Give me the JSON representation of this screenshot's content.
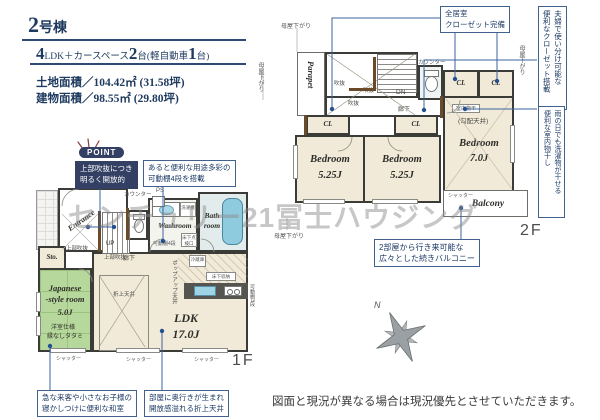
{
  "header": {
    "building_number": "2",
    "building_suffix": "号棟",
    "spec": {
      "n1": "4",
      "t1": "LDK＋カースペース",
      "n2": "2",
      "t2": "台(軽自動車",
      "n3": "1",
      "t3": "台)"
    },
    "land_area": "土地面積／104.42㎡ (31.58坪)",
    "building_area": "建物面積／98.55㎡ (29.80坪)"
  },
  "callouts": {
    "point_badge": "POINT",
    "point_box": [
      "上部吹抜につき",
      "明るく開放的"
    ],
    "closet_all": [
      "全居室",
      "クローゼット完備"
    ],
    "closet_use": [
      "夫婦で使い分け可能な",
      "便利なクローゼット搭載"
    ],
    "indoor_dry": [
      "雨の日でも洗濯物が干せる",
      "便利な室内物干し"
    ],
    "balcony_note": [
      "2部屋から行き来可能な",
      "広々とした続きバルコニー"
    ],
    "shelf_note": [
      "あると便利な用途多彩の",
      "可動棚4段を搭載"
    ],
    "washitsu_note": [
      "急な来客や小さなお子様の",
      "寝かしつけに便利な和室"
    ],
    "ceiling_note": [
      "部屋に奥行きが生まれ",
      "開放感溢れる折上天井"
    ]
  },
  "floor2": {
    "label": "2F",
    "bedroom1": {
      "name": "Bedroom",
      "size": "5.25J"
    },
    "bedroom2": {
      "name": "Bedroom",
      "size": "5.25J"
    },
    "bedroom3": {
      "name": "Bedroom",
      "size": "7.0J",
      "ceiling": "(勾配天井)",
      "dry": "室内物干"
    },
    "labels": {
      "parapet": "Parapet",
      "balcony": "Balcony",
      "cl": "CL",
      "dn": "DN",
      "void": "吹抜",
      "hall": "廊下",
      "counter": "カウンター",
      "moya": "母屋下がり",
      "shutter": "シャッター"
    }
  },
  "floor1": {
    "label": "1F",
    "ldk": {
      "name": "LDK",
      "size": "17.0J"
    },
    "japanese": {
      "l1": "Japanese",
      "l2": "-style room",
      "size": "5.0J",
      "n1": "洋室仕様",
      "n2": "縁なしタタミ"
    },
    "washroom": "Washroom",
    "bathroom": [
      "Bath",
      "room"
    ],
    "storage": "Sto.",
    "entrance": "Entrance",
    "labels": {
      "up": "UP",
      "void_upper": "上部吹抜",
      "hall": "廊下",
      "counter": "カウンター",
      "ps": "PS",
      "popup": "ポップアップ天井",
      "oriage": "折上天井",
      "fridge": "冷蔵庫",
      "floor_storage": "床下収納",
      "washer": "洗濯機",
      "inspection": "床下点検口",
      "shelf4": "可動棚4段",
      "shelf3": "可動棚3段",
      "shutter": "シャッター"
    }
  },
  "watermark": "センチュリー21冨士ハウジング",
  "compass": {
    "north": "N"
  },
  "disclaimer": "図面と現況が異なる場合は現況優先とさせていただきます。"
}
